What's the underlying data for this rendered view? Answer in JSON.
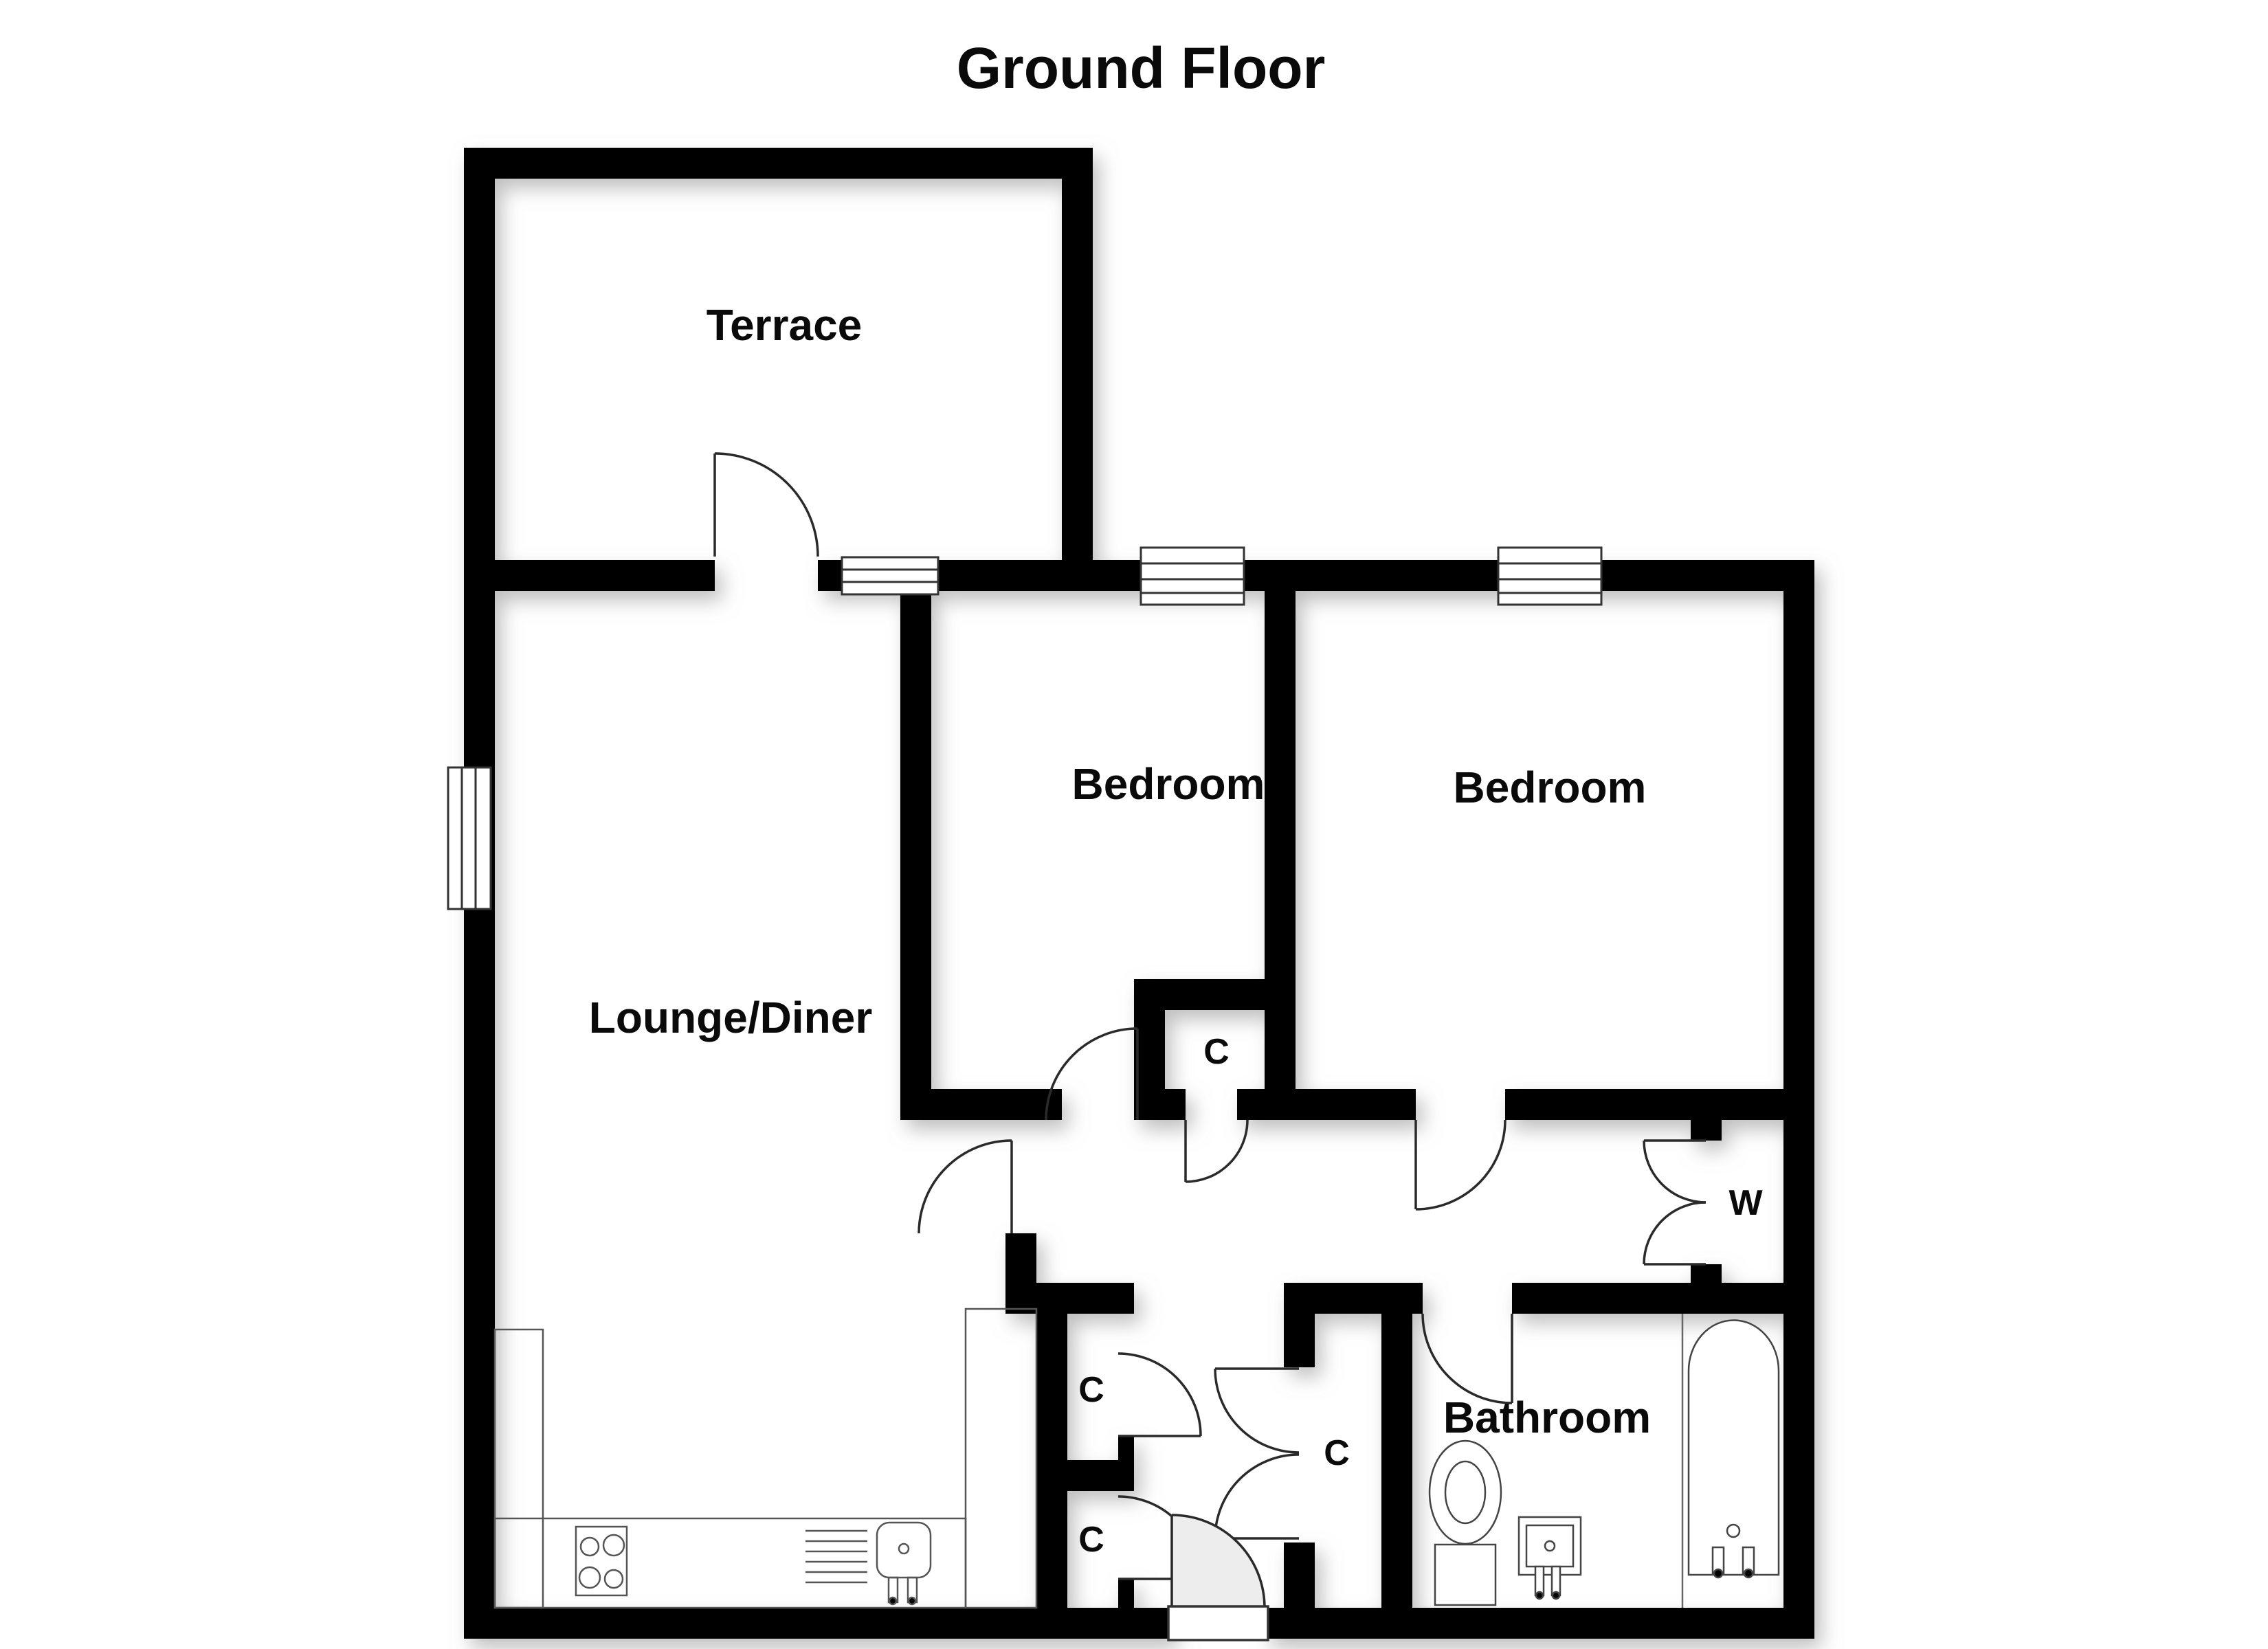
{
  "title": "Ground Floor",
  "rooms": {
    "terrace": "Terrace",
    "lounge": "Lounge/Diner",
    "bedroom1": "Bedroom",
    "bedroom2": "Bedroom",
    "bathroom": "Bathroom"
  },
  "closets": {
    "c1": "C",
    "c2": "C",
    "c3": "C",
    "c4": "C",
    "wardrobe": "W"
  },
  "colors": {
    "wall": "#000000",
    "door_line": "#2a2a2a",
    "fixture_line": "#444444",
    "counter_line": "#555555",
    "shadow": "#8a8a8a",
    "background": "#ffffff"
  }
}
